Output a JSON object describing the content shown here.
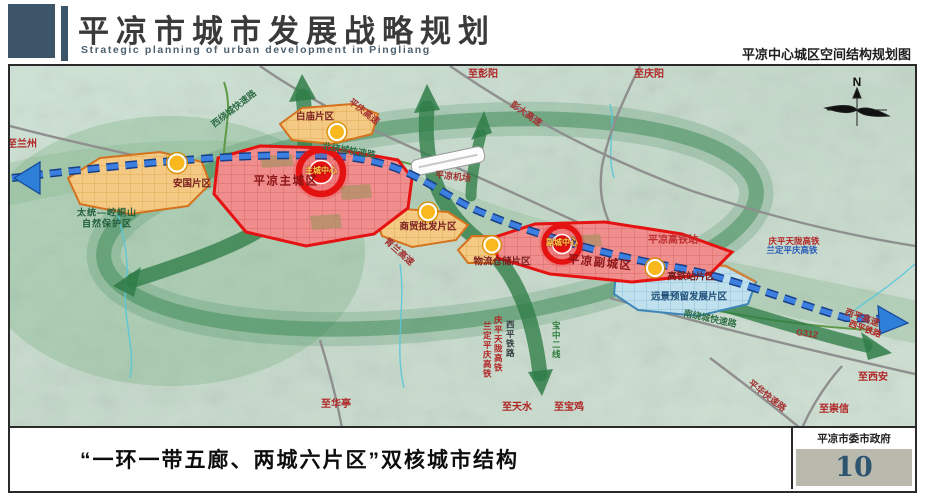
{
  "header": {
    "title_cn": "平凉市城市发展战略规划",
    "title_en": "Strategic planning of urban development in Pingliang",
    "map_subtitle": "平凉中心城区空间结构规划图"
  },
  "footer": {
    "caption": "“一环一带五廊、两城六片区”双核城市结构",
    "agency": "平凉市委市政府",
    "page_number": "10"
  },
  "map": {
    "compass": "N",
    "labels": [
      {
        "text": "至兰州"
      },
      {
        "text": "太统—崆峒山"
      },
      {
        "text": "自然保护区"
      },
      {
        "text": "西绕城快速路"
      },
      {
        "text": "安国片区"
      },
      {
        "text": "平凉主城区"
      },
      {
        "text": "主城中心"
      },
      {
        "text": "白庙片区"
      },
      {
        "text": "平庆高速"
      },
      {
        "text": "至彭阳"
      },
      {
        "text": "彭大高速"
      },
      {
        "text": "至庆阳"
      },
      {
        "text": "北绕城快速路"
      },
      {
        "text": "平凉机场"
      },
      {
        "text": "商贸批发片区"
      },
      {
        "text": "青兰高速"
      },
      {
        "text": "物流仓储片区"
      },
      {
        "text": "副城中心"
      },
      {
        "text": "平凉副城区"
      },
      {
        "text": "平凉高铁站"
      },
      {
        "text": "庆平天陇高铁"
      },
      {
        "text": "兰定平庆高铁"
      },
      {
        "text": "高铁站片区"
      },
      {
        "text": "远景预留发展片区"
      },
      {
        "text": "南绕城快速路"
      },
      {
        "text": "兰定平庆高铁"
      },
      {
        "text": "庆平天陇高铁"
      },
      {
        "text": "西平铁路"
      },
      {
        "text": "宝中二线"
      },
      {
        "text": "至华亭"
      },
      {
        "text": "至天水"
      },
      {
        "text": "至宝鸡"
      },
      {
        "text": "G312"
      },
      {
        "text": "西平高速"
      },
      {
        "text": "西平铁路"
      },
      {
        "text": "至西安"
      },
      {
        "text": "平华快速路"
      },
      {
        "text": "至崇信"
      }
    ],
    "colors": {
      "zone_red": "#e51212",
      "zone_orange": "#e08a1e",
      "zone_blue": "#8fc2d8",
      "railway_blue": "#2b66c8",
      "corridor_green": "#2f7d48",
      "header_block": "#3d5568",
      "page_number_blue": "#2e5570"
    }
  }
}
